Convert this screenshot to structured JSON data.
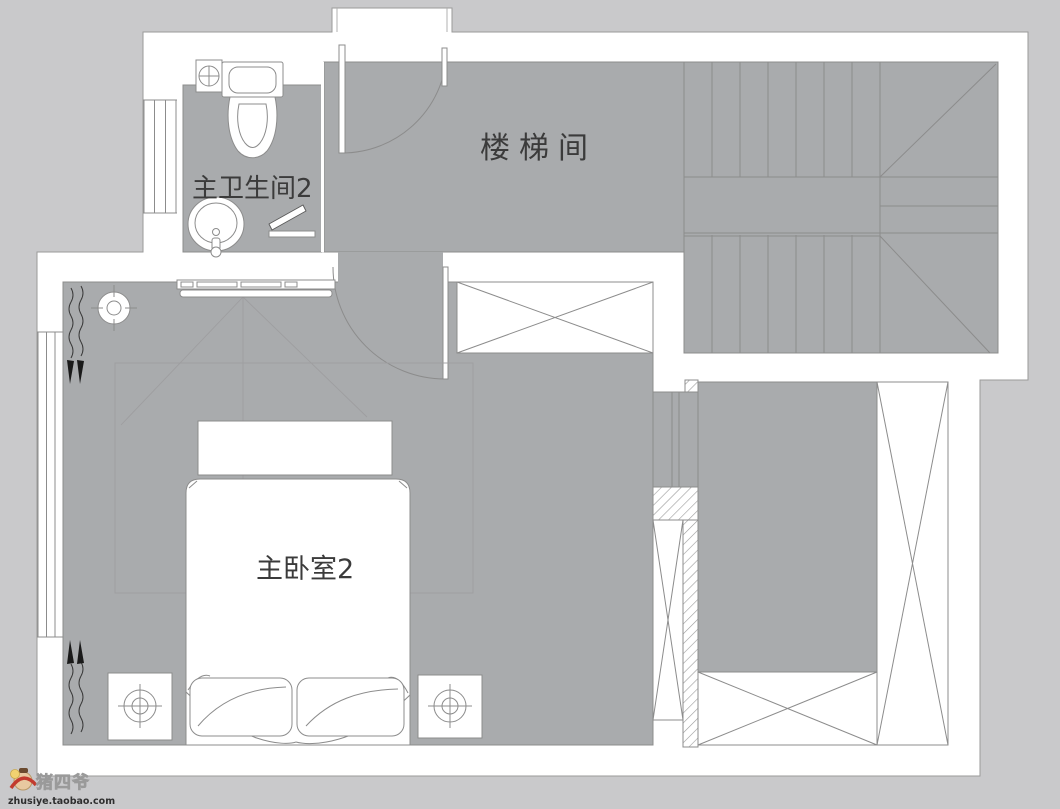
{
  "plan": {
    "type": "residential floor plan",
    "rooms": [
      {
        "id": "stairwell",
        "label": "楼梯间"
      },
      {
        "id": "master-bathroom-2",
        "label": "主卫生间2"
      },
      {
        "id": "master-bedroom-2",
        "label": "主卧室2"
      }
    ],
    "symbols": [
      "stairs",
      "toilet",
      "wash-basin",
      "bed",
      "pillow",
      "nightstand-lamp",
      "wardrobe",
      "bench",
      "tv-cabinet",
      "curtain",
      "downlight",
      "door-swing",
      "window"
    ]
  },
  "watermark": {
    "brand": "猪四爷",
    "site": "zhusiye.taobao.com"
  },
  "colors": {
    "background": "#c9c9cb",
    "wall_fill": "#ffffff",
    "floor_fill": "#a9abad",
    "line": "#8c8c8c",
    "label_text": "#3b3b3b",
    "watermark_red": "#c23b2e",
    "watermark_tan": "#e8c9a0"
  }
}
